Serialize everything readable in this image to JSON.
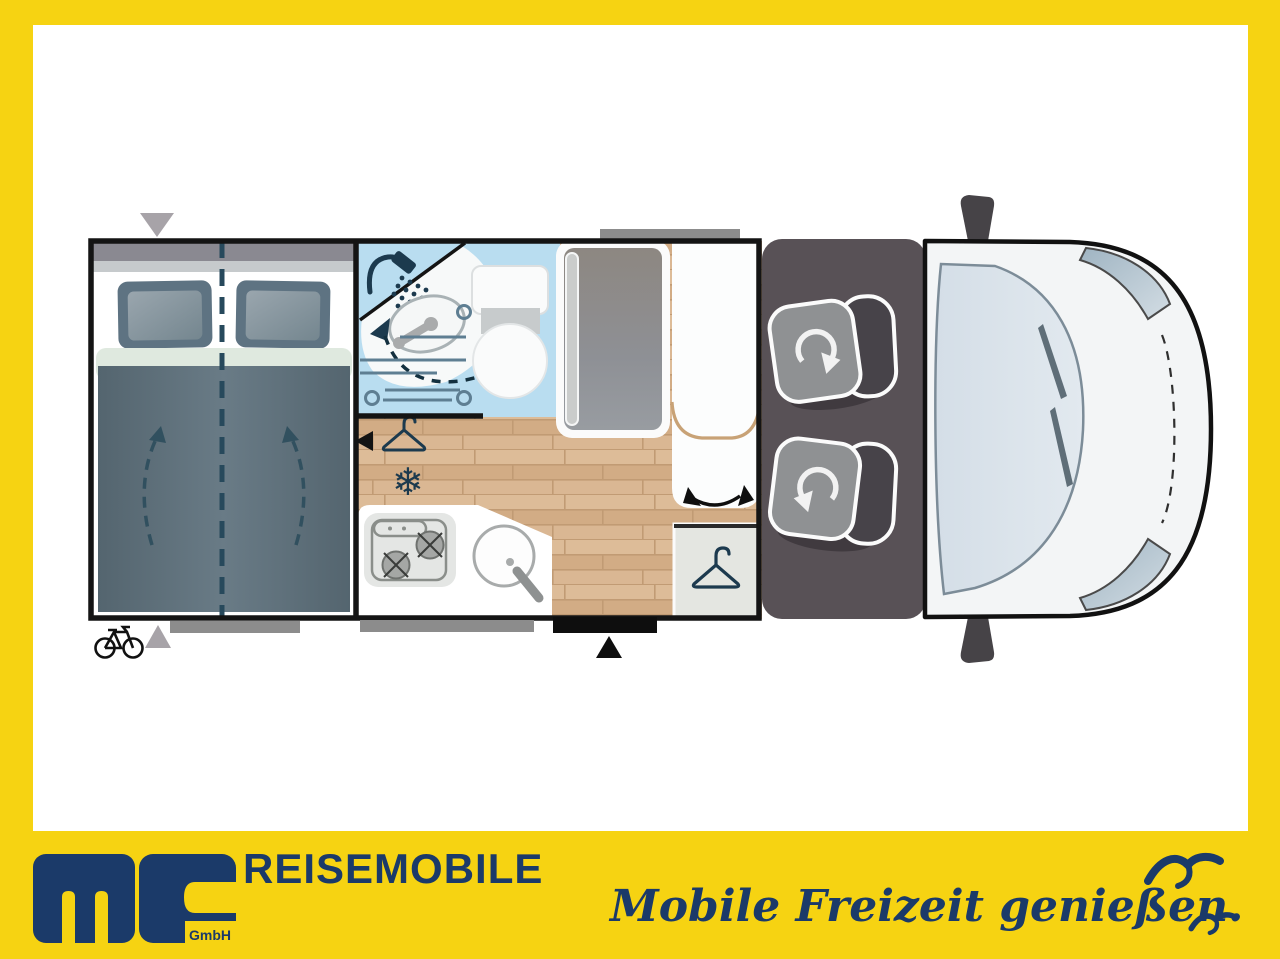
{
  "window": {
    "width": 1280,
    "height": 959
  },
  "colors": {
    "frame_yellow": "#F6D312",
    "brand_navy": "#1B3A69",
    "wall_black": "#141414",
    "bathroom_blue": "#B9DDF0",
    "wood_floor": "#D8B591",
    "bed_slate": "#5E7280",
    "sheet_mint": "#DFE9DF",
    "cab_charcoal": "#585156",
    "seat_gray": "#8F9193",
    "seat_back_dark": "#474349",
    "marker_gray": "#8C8C8C",
    "wardrobe_gray": "#E4E6E1",
    "windshield_blue": "#DBE3EB",
    "tan_outline": "#C8A276",
    "icon_navy": "#1C3A4E"
  },
  "footer": {
    "brand": "REISEMOBILE",
    "logo_company": "GmbH",
    "tagline": "Mobile Freizeit genießen."
  },
  "floorplan": {
    "icons": {
      "snowflake_glyph": "❄",
      "names": [
        "shower-icon",
        "washbasin-icon",
        "toilet-icon",
        "clothes-hanger-icon",
        "snowflake-icon",
        "stove-icon",
        "sink-icon",
        "bike-icon",
        "rotation-arrow-icon",
        "swing-arrow-icon",
        "entry-arrow-icon",
        "flap-marker",
        "door-marker"
      ]
    }
  }
}
